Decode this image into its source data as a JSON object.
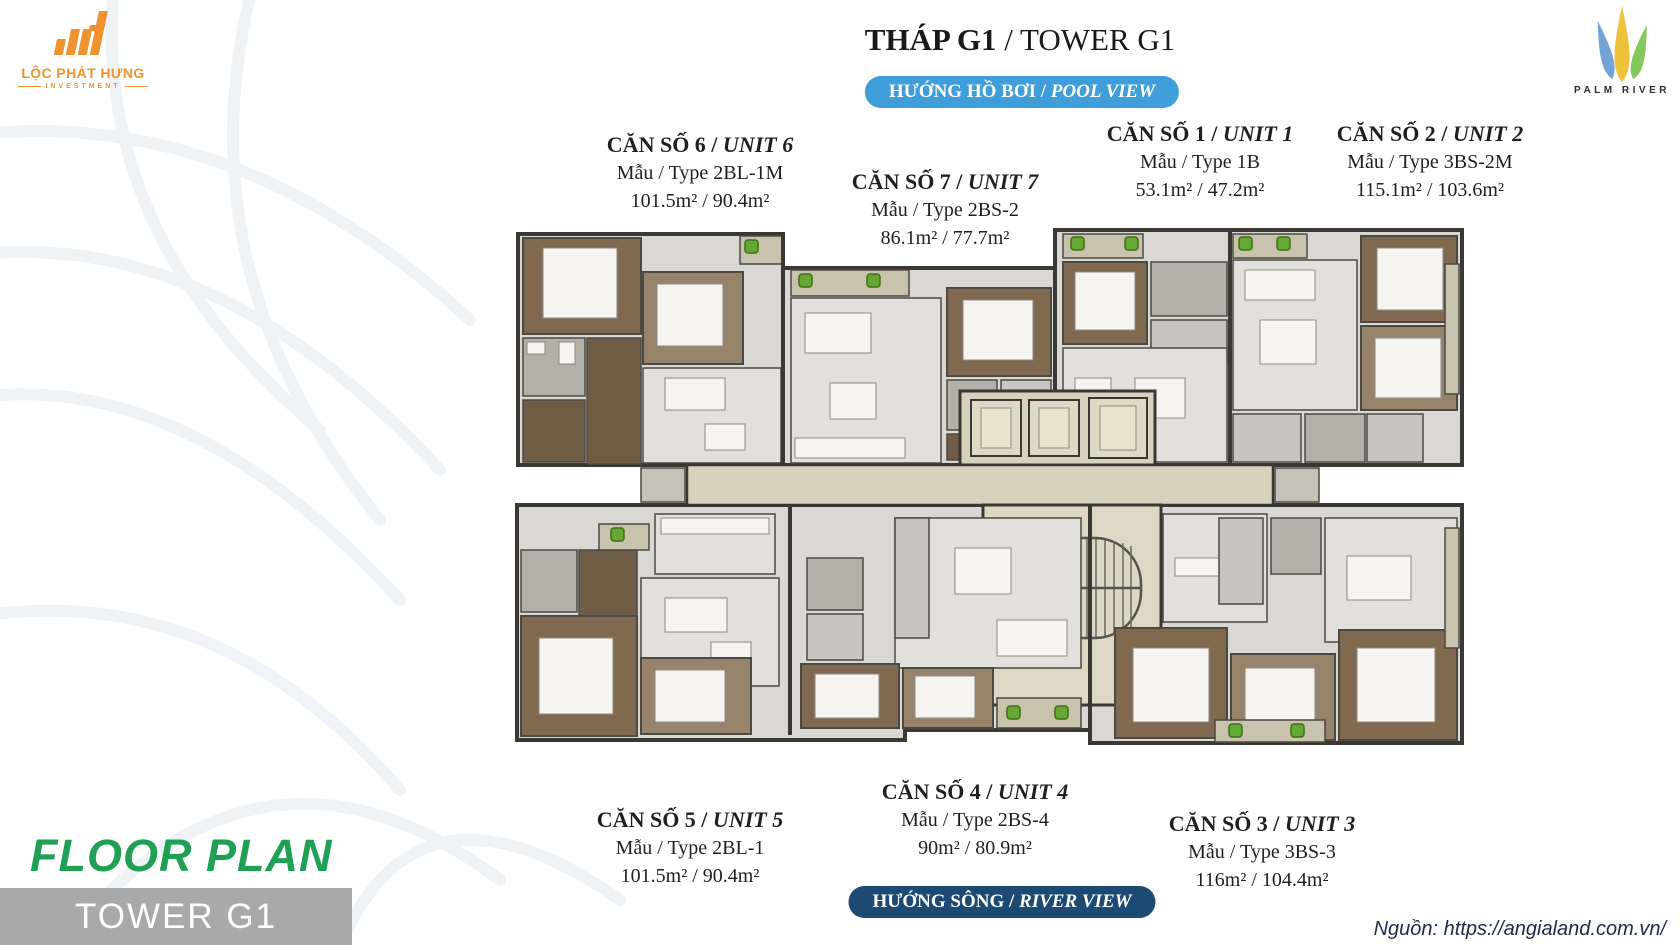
{
  "sep": " / ",
  "header": {
    "title_vi": "THÁP G1",
    "title_en": "TOWER G1",
    "pool_badge_vi": "HƯỚNG HỒ BƠI",
    "pool_badge_en": "POOL VIEW",
    "river_badge_vi": "HƯỚNG SÔNG",
    "river_badge_en": "RIVER VIEW"
  },
  "logos": {
    "developer": {
      "name": "LỘC PHÁT HƯNG",
      "sub": "INVESTMENT"
    },
    "project": {
      "name": "PALM RIVER"
    }
  },
  "units": [
    {
      "name_vi": "CĂN SỐ 1",
      "name_en": "UNIT 1",
      "type_label": "Mẫu / Type 1B",
      "area_label": "53.1m² / 47.2m²"
    },
    {
      "name_vi": "CĂN SỐ 2",
      "name_en": "UNIT 2",
      "type_label": "Mẫu / Type 3BS-2M",
      "area_label": "115.1m² / 103.6m²"
    },
    {
      "name_vi": "CĂN SỐ 3",
      "name_en": "UNIT 3",
      "type_label": "Mẫu / Type 3BS-3",
      "area_label": "116m² / 104.4m²"
    },
    {
      "name_vi": "CĂN SỐ 4",
      "name_en": "UNIT 4",
      "type_label": "Mẫu / Type 2BS-4",
      "area_label": "90m² / 80.9m²"
    },
    {
      "name_vi": "CĂN SỐ 5",
      "name_en": "UNIT 5",
      "type_label": "Mẫu / Type 2BL-1",
      "area_label": "101.5m² / 90.4m²"
    },
    {
      "name_vi": "CĂN SỐ 6",
      "name_en": "UNIT 6",
      "type_label": "Mẫu / Type 2BL-1M",
      "area_label": "101.5m² / 90.4m²"
    },
    {
      "name_vi": "CĂN SỐ 7",
      "name_en": "UNIT 7",
      "type_label": "Mẫu / Type 2BS-2",
      "area_label": "86.1m² / 77.7m²"
    }
  ],
  "footer": {
    "floor_plan": "FLOOR PLAN",
    "tower": "TOWER G1",
    "source": "Nguồn: https://angialand.com.vn/"
  },
  "icons": {
    "developer_logo": "orange-rising-bars",
    "project_logo": "three-palm-leaves",
    "plant_marker": "green-plant"
  },
  "colors": {
    "pool_badge": "#3f9ed9",
    "river_badge": "#1d4a72",
    "floor_plan_green": "#1fa055",
    "tower_bar_gray": "#a9a9a9",
    "developer_orange": "#ef9330",
    "palm_blue": "#6d9ed3",
    "palm_yellow": "#efc23b",
    "palm_green": "#7fc453",
    "plan_wall": "#3b3833",
    "plan_corridor_beige": "#d8d1bb",
    "plan_wood": "#80694f"
  }
}
